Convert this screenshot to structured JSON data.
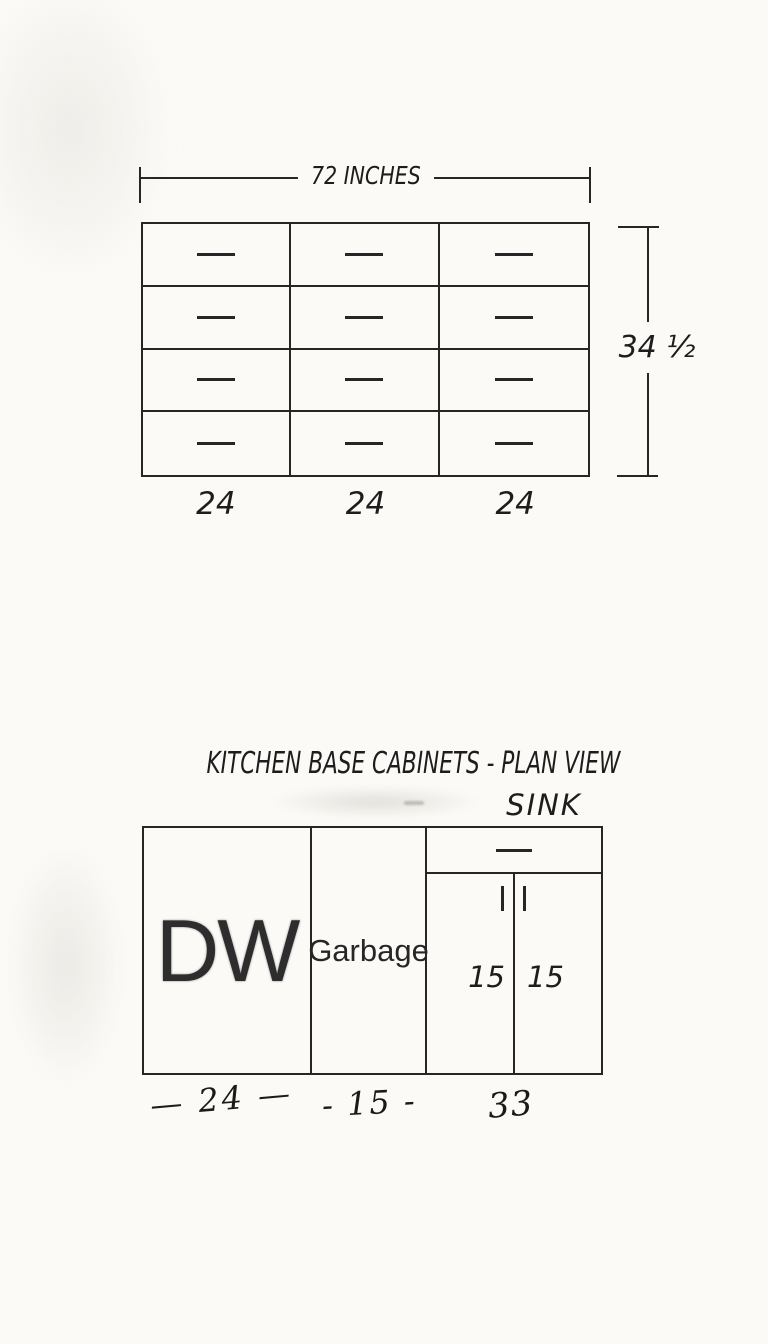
{
  "top_drawing": {
    "width_label": "72 INCHES",
    "height_label": "34 ½",
    "columns": 3,
    "rows": 4,
    "column_widths": [
      "24",
      "24",
      "24"
    ]
  },
  "bottom_drawing": {
    "title": "KITCHEN BASE CABINETS - PLAN VIEW",
    "sink_label": "SINK",
    "dishwasher_label": "DW",
    "garbage_label": "Garbage",
    "door_widths": [
      "15",
      "15"
    ],
    "dimension_labels": [
      "— 24 —",
      "- 15 -",
      "33"
    ]
  },
  "colors": {
    "ink": "#262626",
    "paper": "#fbfaf7"
  }
}
